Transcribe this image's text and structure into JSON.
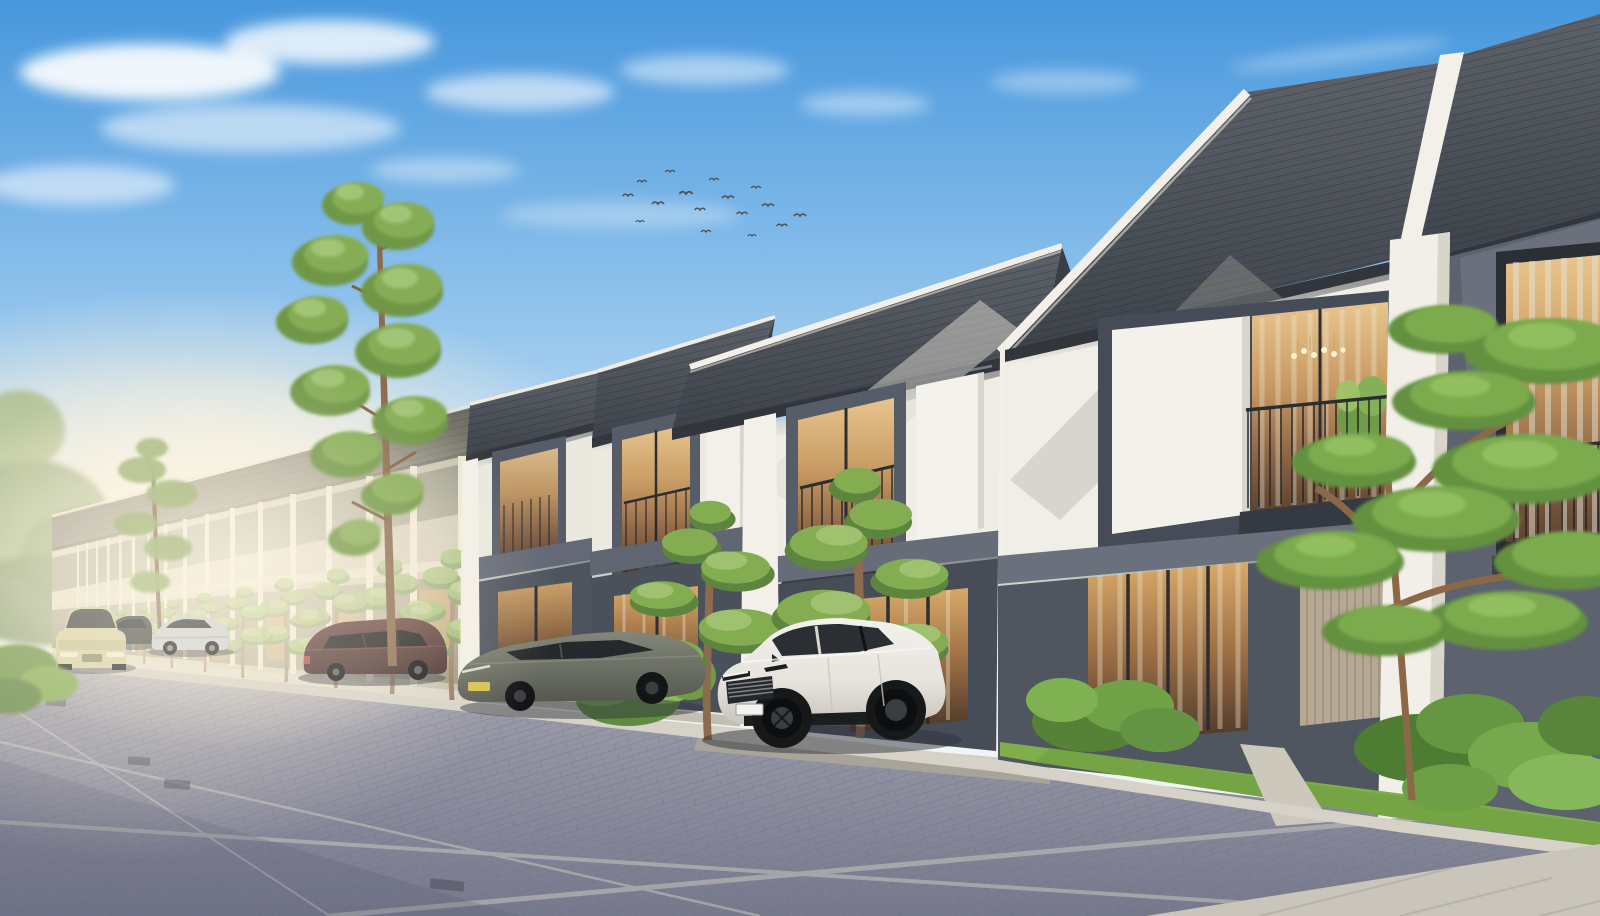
{
  "scene": {
    "title": "Row of modern two-storey townhouses in warm morning light — exterior architectural render",
    "setting": "residential street receding to the left, brick-paved road, parked cars, ornamental trees",
    "sky": {
      "top_color": "#4797dd",
      "mid_color": "#a9cfee",
      "horizon_color": "#f8f1e2",
      "cloud_color": "#ffffff",
      "bird_count": 16,
      "bird_color": "#4b5054"
    },
    "buildings": {
      "style": "two-storey modern tropical townhouses, attached row",
      "visible_units": "approx 12 units receding toward the left",
      "roof": "dark grey tile gable roofs with white sloped ridge trims",
      "roof_color": "#474b53",
      "roof_trim_color": "#f2f0e8",
      "upper_facade_color": "#efede6",
      "accent_panel_color": "#565c66",
      "lower_facade_color": "#4b515b",
      "pillar_color": "#f2f0e9",
      "distant_facade_color": "#c6c4b0",
      "window_frame_color": "#2c2f35",
      "window_glow_color": "#c89055",
      "railing_color": "#26292d",
      "features": [
        "juliet balconies with thin black railings",
        "white sliding shutter panels",
        "ground-floor glass doors with warm interior light",
        "chandelier visible in right-hand upstairs window",
        "potted plant on balcony",
        "beige slatted garage door",
        "white party-wall pillars between units"
      ]
    },
    "street": {
      "surface": "dark blue-grey brick pavers with light concrete gutter strips",
      "road_color": "#8c8ea0",
      "seam_color": "#c9c6bd",
      "curb_color": "#d6d2c8",
      "sidewalk_color": "#c9c5ba",
      "drain_color": "#565a68"
    },
    "vehicles": [
      {
        "name": "white-suv",
        "color": "#eceae6",
        "position": "parked in driveway front centre, angled toward viewer"
      },
      {
        "name": "olive-sedan",
        "color": "#767a6e",
        "position": "parked in driveway left of the SUV"
      },
      {
        "name": "maroon-mpv",
        "color": "#573a3a",
        "position": "parked at mid distance"
      },
      {
        "name": "silver-sedan",
        "color": "#c9ccce",
        "position": "parked in far distance"
      },
      {
        "name": "champagne-sedan",
        "color": "#d6cf9f",
        "position": "driving on road at far left, facing viewer"
      },
      {
        "name": "dark-sedan",
        "color": "#3c403e",
        "position": "parked far distance, partly hidden"
      }
    ],
    "vegetation": {
      "tall_pine": {
        "foliage_color": "#86ad56",
        "trunk_color": "#8d6b4e",
        "position": "left-centre, rises high above roofline"
      },
      "medium_pine": {
        "position": "far left above distant houses"
      },
      "ornamental_trees": "layered niwaki-style pines in front of each unit",
      "large_right_tree": "broad layered canopy in front of nearest dark facade",
      "shrubs": "tropical plants, monstera leaves and yellow flowers in garden beds",
      "grass_color": "#7fae4a",
      "background_trees_color": "#87a06b"
    }
  },
  "palette": {
    "roof": "#42464e",
    "roof_trim": "#f2f0e8",
    "upper_facade": "#efede6",
    "accent_slate": "#565c66",
    "lower_facade": "#4b515b",
    "pillar": "#f2f0e9",
    "distant_facade": "#c6c4b0",
    "window_glow": "#c89055",
    "railing": "#26292d",
    "road": "#8c8ea0",
    "curb": "#d6d2c8",
    "grass": "#7fae4a",
    "foliage": "#86ad56",
    "trunk": "#8d6b4e",
    "shadow": "#33363f"
  }
}
